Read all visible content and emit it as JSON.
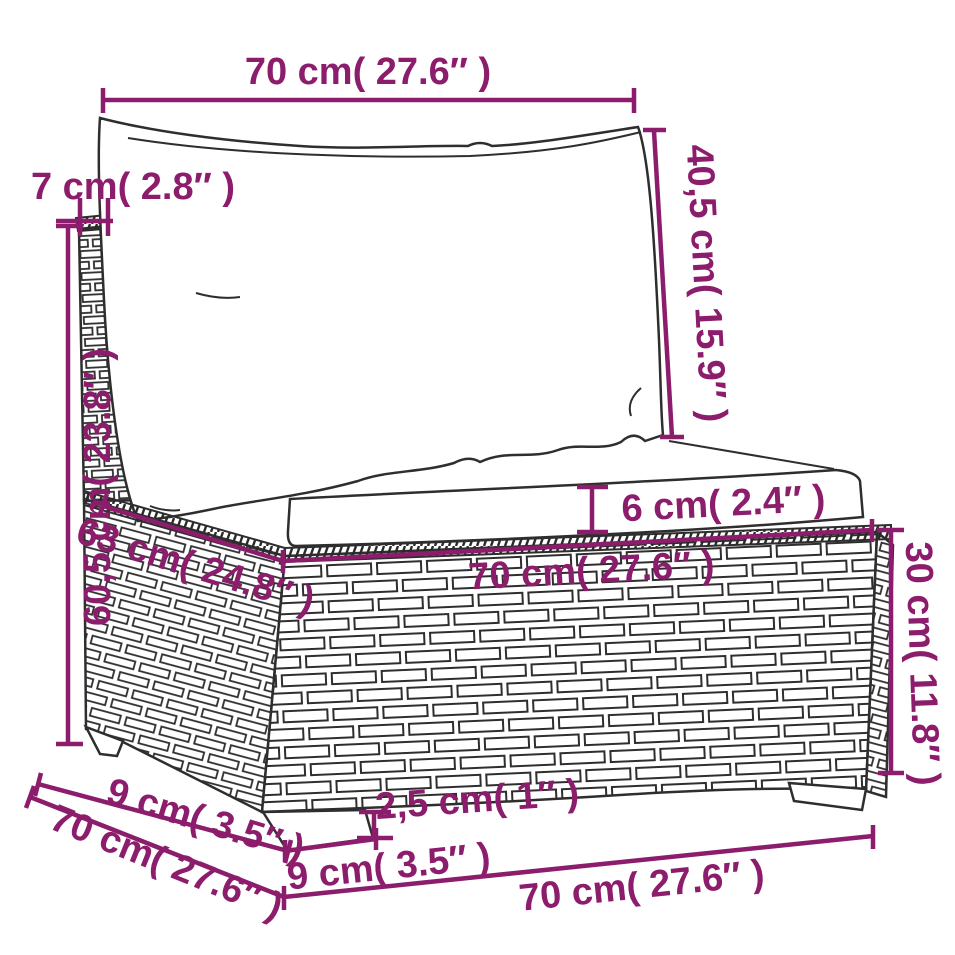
{
  "colors": {
    "accent": "#8C1C6C",
    "line_art": "#2e2e2e",
    "background": "#ffffff",
    "cushion_fill": "#ffffff"
  },
  "dims": {
    "back_cushion_width": "70 cm( 27.6″ )",
    "back_panel_thickness": "7 cm( 2.8″ )",
    "back_cushion_height": "40,5 cm( 15.9″ )",
    "total_height": "60,5 cm( 23.8″ )",
    "seat_cushion_thickness": "6 cm( 2.4″ )",
    "seat_depth": "63 cm( 24.8″ )",
    "seat_width": "70 cm( 27.6″ )",
    "base_height": "30 cm( 11.8″ )",
    "total_depth": "70 cm( 27.6″ )",
    "leg_inset_depth": "9 cm( 3.5″ )",
    "leg_height": "2,5 cm( 1″ )",
    "leg_width": "9 cm( 3.5″ )",
    "base_width": "70 cm( 27.6″ )"
  }
}
